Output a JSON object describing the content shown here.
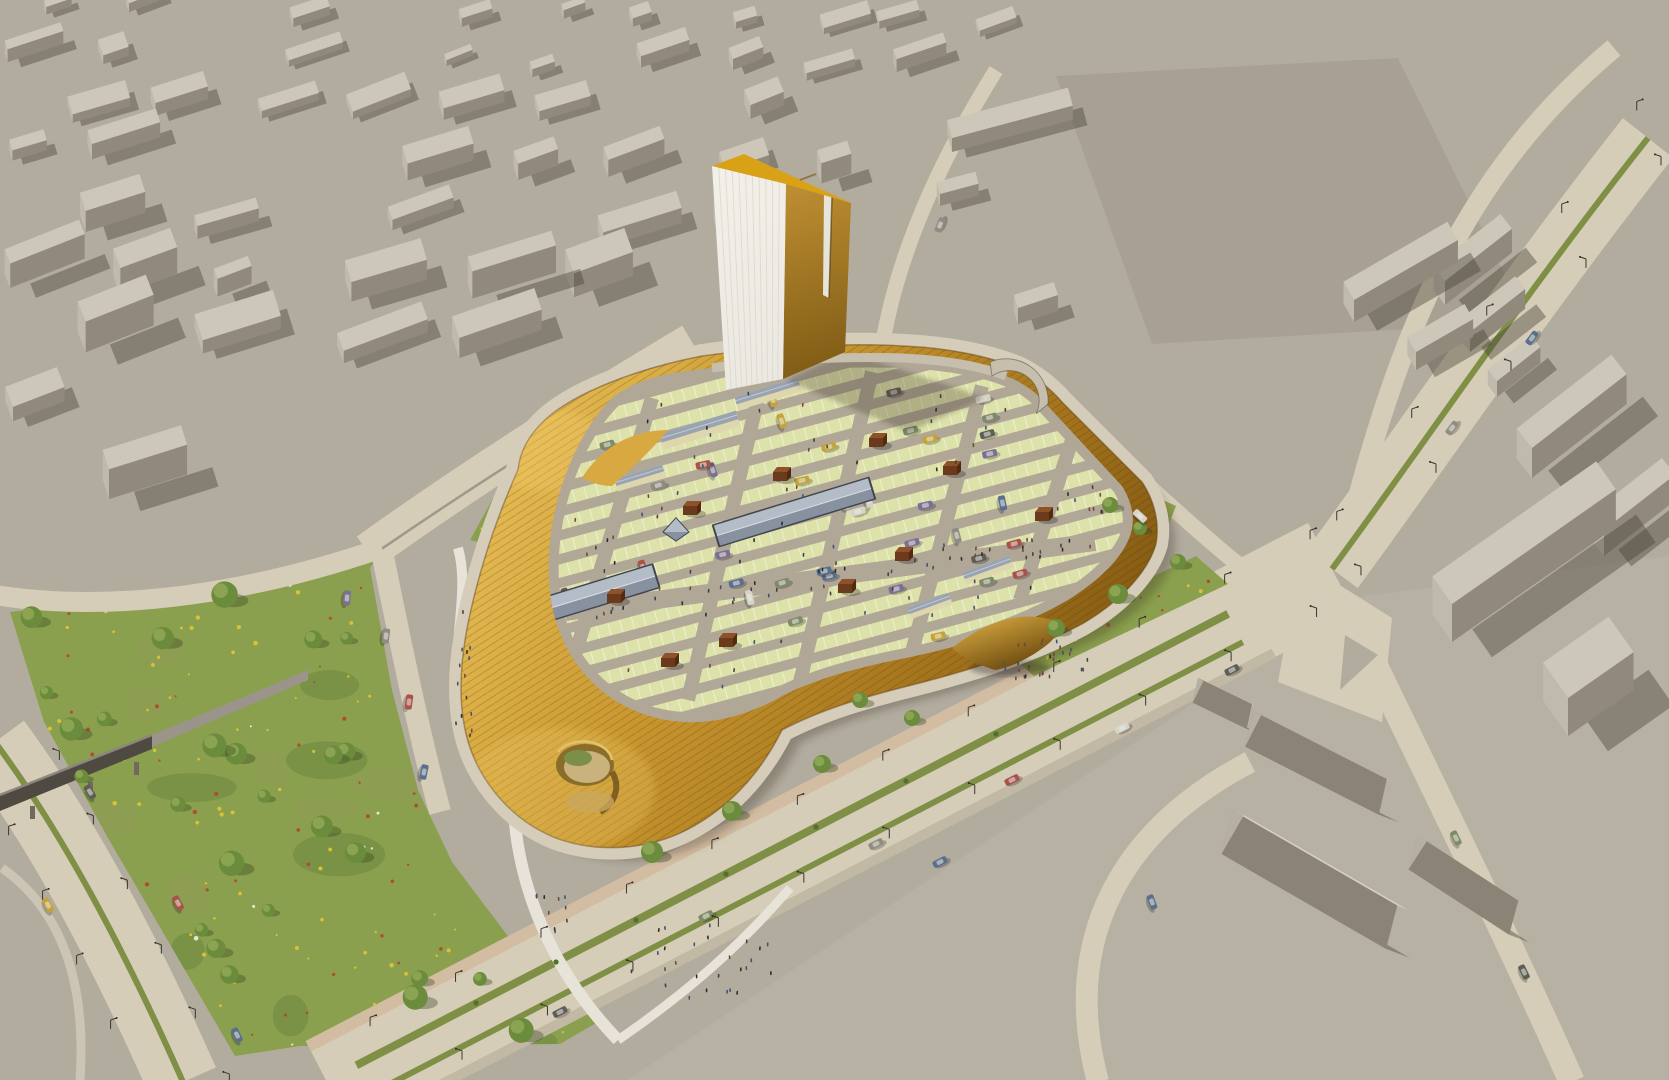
{
  "image": {
    "kind": "architectural-aerial-rendering",
    "subject": "golden shopping-centre with rooftop parking deck, office tower, surrounding gray massing model city, park and boulevards"
  },
  "palette": {
    "ground": "#b2ac9f",
    "plaza_br": "#b7b1a3",
    "lot": "#a8a193",
    "road": "#d6cdb8",
    "road_edge": "#c2b9a4",
    "sidewalk_pink": "#d3bda2",
    "path_white": "#e7e3d8",
    "median_green": "#7f8f45",
    "grass": "#8aa04e",
    "grass_dark": "rgba(70,95,40,0.22)",
    "grass_dry": "rgba(152,150,95,0.28)",
    "tree_md": "#6b8c3c",
    "tree_lt": "#8fa856",
    "tree_shadow": "rgba(50,62,30,0.35)",
    "flower_yellow": "#d9c235",
    "flower_red": "#ad4f2c",
    "flower_white": "#e8e6da",
    "gold_hi": "#e7bd55",
    "gold_md": "#c9972f",
    "gold_lo": "#a3731c",
    "gold_dk": "#7a5310",
    "deck_aisle": "#b0a797",
    "deck_stall": "#dde2ab",
    "stall_line": "#eef0cf",
    "deck_edge": "#c6bfae",
    "sky_dk": "#42474f",
    "sky_md": "#87919f",
    "sky_lt": "#b3bcc7",
    "shed_cream": "#ded6ad",
    "shed_roof": "#9aa4b0",
    "kiosk_top": "#8f5127",
    "kiosk_front": "#6b3a1c",
    "kiosk_side": "#53290f",
    "block_top": "#cdc7ba",
    "block_left": "#c0baad",
    "block_right": "#918a7c",
    "block_shadow": "rgba(72,66,56,0.42)",
    "roofL": "#d6d0c3",
    "roofR": "#8b8375",
    "gable_end": "#b7b0a2",
    "tower_front": "#eae8e0",
    "tower_stripe": "#d8d6ca",
    "tower_top": "#d9a115",
    "notch": "#e7e5da",
    "bridge_dark": "#4e4941",
    "bridge_ramp": "#9b948a",
    "facade_dark": "#35322c",
    "people": [
      "#45413a",
      "#6e4a3a",
      "#3e5570",
      "#2f2c27"
    ],
    "car_colors": [
      "#8f8c84",
      "#5f5d58",
      "#5a6f8e",
      "#a8524a",
      "#c3a33a",
      "#7e8a69",
      "#d6d4ca",
      "#7b6f93"
    ]
  },
  "scene": {
    "seed": 1234,
    "city": {
      "seed": 7,
      "rows": 9,
      "cols": 14,
      "angle": -19,
      "poly": [
        [
          0,
          0
        ],
        [
          1048,
          0
        ],
        [
          996,
          74
        ],
        [
          884,
          336
        ],
        [
          742,
          342
        ],
        [
          600,
          368
        ],
        [
          456,
          408
        ],
        [
          300,
          436
        ],
        [
          0,
          548
        ]
      ]
    },
    "lot_poly": [
      [
        1056,
        76
      ],
      [
        1398,
        58
      ],
      [
        1528,
        322
      ],
      [
        1152,
        344
      ]
    ],
    "plaza_br_poly": [
      [
        620,
        1085
      ],
      [
        1352,
        598
      ],
      [
        1669,
        556
      ],
      [
        1669,
        1085
      ]
    ],
    "right_blocks": [
      {
        "x": 1445,
        "y": 305,
        "w": 85,
        "d": 30,
        "h": 24,
        "a": -38
      },
      {
        "x": 1470,
        "y": 352,
        "w": 70,
        "d": 26,
        "h": 20,
        "a": -38
      },
      {
        "x": 1497,
        "y": 397,
        "w": 55,
        "d": 24,
        "h": 16,
        "a": -38
      },
      {
        "x": 1532,
        "y": 478,
        "w": 120,
        "d": 40,
        "h": 30,
        "a": -38
      },
      {
        "x": 1604,
        "y": 556,
        "w": 90,
        "d": 34,
        "h": 26,
        "a": -38
      },
      {
        "x": 1452,
        "y": 642,
        "w": 200,
        "d": 55,
        "h": 38,
        "a": -35
      },
      {
        "x": 1568,
        "y": 736,
        "w": 80,
        "d": 70,
        "h": 38,
        "a": -35
      },
      {
        "x": 952,
        "y": 152,
        "w": 125,
        "d": 30,
        "h": 14,
        "a": -15
      },
      {
        "x": 940,
        "y": 206,
        "w": 40,
        "d": 20,
        "h": 12,
        "a": -15
      },
      {
        "x": 1018,
        "y": 324,
        "w": 42,
        "d": 22,
        "h": 16,
        "a": -18
      },
      {
        "x": 1354,
        "y": 322,
        "w": 120,
        "d": 34,
        "h": 22,
        "a": -30
      },
      {
        "x": 1416,
        "y": 370,
        "w": 66,
        "d": 28,
        "h": 18,
        "a": -30
      }
    ],
    "gables": [
      {
        "cx": 1225,
        "cy": 705,
        "len": 60,
        "wid": 30,
        "h": 14,
        "a": 26
      },
      {
        "cx": 1320,
        "cy": 765,
        "len": 150,
        "wid": 44,
        "h": 20,
        "a": 27
      },
      {
        "cx": 1315,
        "cy": 882,
        "len": 190,
        "wid": 56,
        "h": 24,
        "a": 30
      },
      {
        "cx": 1468,
        "cy": 888,
        "len": 120,
        "wid": 42,
        "h": 20,
        "a": 33
      }
    ],
    "deck_poly": [
      [
        718,
        378
      ],
      [
        900,
        368
      ],
      [
        1000,
        382
      ],
      [
        1110,
        494
      ],
      [
        1118,
        528
      ],
      [
        1060,
        592
      ],
      [
        960,
        640
      ],
      [
        860,
        664
      ],
      [
        770,
        696
      ],
      [
        690,
        710
      ],
      [
        610,
        690
      ],
      [
        570,
        640
      ],
      [
        562,
        560
      ],
      [
        580,
        480
      ],
      [
        610,
        410
      ]
    ],
    "deck_lanes": [
      [
        652,
        398,
        576,
        652
      ],
      [
        762,
        380,
        688,
        700
      ],
      [
        872,
        372,
        800,
        682
      ],
      [
        982,
        386,
        912,
        652
      ],
      [
        1072,
        440,
        1020,
        600
      ]
    ],
    "deck_spine": [
      565,
      612,
      1095,
      542
    ],
    "skylights": [
      {
        "cx": 590,
        "cy": 596,
        "len": 140,
        "w": 26,
        "a": -17
      },
      {
        "cx": 794,
        "cy": 512,
        "len": 165,
        "w": 24,
        "a": -17
      }
    ],
    "sheds": [
      {
        "cx": 700,
        "cy": 430,
        "len": 80,
        "w": 16,
        "a": -17
      },
      {
        "cx": 768,
        "cy": 394,
        "len": 66,
        "w": 14,
        "a": -17
      },
      {
        "cx": 640,
        "cy": 478,
        "len": 50,
        "w": 13,
        "a": -17
      },
      {
        "cx": 988,
        "cy": 570,
        "len": 50,
        "w": 13,
        "a": -20
      },
      {
        "cx": 930,
        "cy": 606,
        "len": 44,
        "w": 12,
        "a": -20
      }
    ],
    "pyramid": {
      "cx": 676,
      "cy": 532,
      "s": 26
    },
    "kiosks": [
      [
        780,
        476
      ],
      [
        690,
        510
      ],
      [
        876,
        442
      ],
      [
        950,
        470
      ],
      [
        1042,
        516
      ],
      [
        902,
        556
      ],
      [
        845,
        588
      ],
      [
        668,
        662
      ],
      [
        726,
        642
      ],
      [
        614,
        598
      ]
    ],
    "deck_cars": 40,
    "deck_people": 70,
    "spine_people": 40,
    "park_poly": [
      [
        10,
        612
      ],
      [
        200,
        590
      ],
      [
        382,
        552
      ],
      [
        370,
        568
      ],
      [
        392,
        690
      ],
      [
        418,
        790
      ],
      [
        452,
        862
      ],
      [
        520,
        952
      ],
      [
        598,
        1022
      ],
      [
        560,
        1044
      ],
      [
        300,
        1046
      ],
      [
        235,
        1056
      ],
      [
        108,
        838
      ],
      [
        44,
        722
      ]
    ],
    "park_trees": 26,
    "park_flowers": 130,
    "park_blotches": 14,
    "gardens": [
      {
        "poly": [
          [
            1002,
            648
          ],
          [
            1196,
            556
          ],
          [
            1228,
            584
          ],
          [
            1034,
            676
          ]
        ],
        "flowers": 18,
        "red": true
      },
      {
        "poly": [
          [
            1096,
            470
          ],
          [
            1176,
            506
          ],
          [
            1152,
            566
          ],
          [
            1078,
            538
          ]
        ],
        "flowers": 10,
        "red": true
      },
      {
        "poly": [
          [
            470,
            540
          ],
          [
            502,
            482
          ],
          [
            566,
            500
          ],
          [
            540,
            556
          ]
        ],
        "flowers": 12,
        "red": false
      }
    ],
    "garden_trees": [
      [
        1056,
        628,
        9
      ],
      [
        1118,
        594,
        10
      ],
      [
        1178,
        562,
        8
      ],
      [
        1110,
        505,
        8
      ],
      [
        1140,
        528,
        7
      ],
      [
        652,
        852,
        11
      ],
      [
        732,
        811,
        10
      ],
      [
        822,
        764,
        9
      ],
      [
        912,
        718,
        8
      ],
      [
        860,
        700,
        8
      ]
    ],
    "crowds": [
      {
        "x": 1045,
        "y": 662,
        "rx": 45,
        "ry": 24,
        "n": 28
      },
      {
        "x": 700,
        "y": 962,
        "rx": 80,
        "ry": 38,
        "n": 26
      },
      {
        "x": 462,
        "y": 680,
        "rx": 12,
        "ry": 90,
        "n": 14
      },
      {
        "x": 560,
        "y": 905,
        "rx": 25,
        "ry": 40,
        "n": 10
      },
      {
        "x": 1090,
        "y": 500,
        "rx": 25,
        "ry": 18,
        "n": 8
      }
    ],
    "road_cars": [
      [
        48,
        905,
        62,
        4
      ],
      [
        178,
        903,
        62,
        3
      ],
      [
        237,
        1035,
        64,
        2
      ],
      [
        90,
        792,
        58,
        1
      ],
      [
        347,
        598,
        95,
        7
      ],
      [
        409,
        702,
        98,
        3
      ],
      [
        424,
        772,
        102,
        2
      ],
      [
        560,
        1012,
        -27,
        1
      ],
      [
        706,
        916,
        -27,
        5
      ],
      [
        876,
        844,
        -27,
        0
      ],
      [
        1012,
        780,
        -27,
        3
      ],
      [
        1122,
        728,
        -27,
        6
      ],
      [
        1232,
        670,
        -27,
        1
      ],
      [
        940,
        862,
        -27,
        2
      ],
      [
        1452,
        428,
        -53,
        0
      ],
      [
        1532,
        338,
        -53,
        2
      ],
      [
        1456,
        838,
        64,
        5
      ],
      [
        1524,
        972,
        64,
        1
      ],
      [
        1152,
        902,
        70,
        2
      ],
      [
        1140,
        516,
        42,
        6
      ],
      [
        940,
        225,
        -68,
        0
      ],
      [
        386,
        636,
        97,
        0
      ]
    ],
    "median_bushes": [
      [
        476,
        1003
      ],
      [
        556,
        962
      ],
      [
        636,
        920
      ],
      [
        726,
        874
      ],
      [
        816,
        827
      ],
      [
        906,
        781
      ],
      [
        996,
        734
      ]
    ],
    "boulevard": {
      "p1": [
        330,
        1088
      ],
      "p2": [
        1332,
        569
      ],
      "w": 104
    },
    "lamp_lines": [
      {
        "p1": [
          360,
          1072
        ],
        "p2": [
          1300,
          585
        ],
        "off": 36,
        "n": 11
      },
      {
        "p1": [
          10,
          752
        ],
        "p2": [
          180,
          1075
        ],
        "off": 40,
        "n": 5
      },
      {
        "p1": [
          1340,
          560
        ],
        "p2": [
          1640,
          150
        ],
        "off": 26,
        "n": 4
      }
    ]
  }
}
